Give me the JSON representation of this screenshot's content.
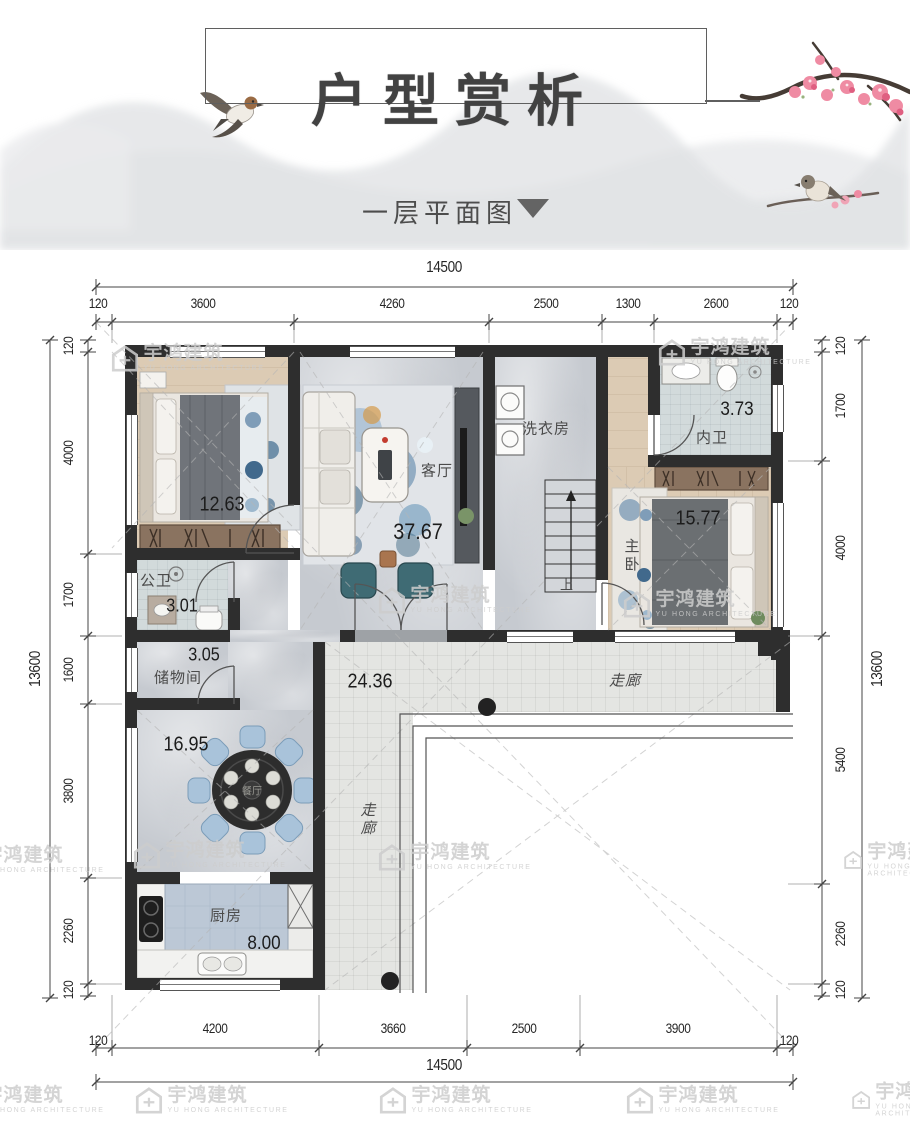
{
  "header": {
    "title": "户型赏析",
    "subtitle": "一层平面图"
  },
  "watermark": {
    "cn": "宇鸿建筑",
    "en": "YU HONG ARCHITECTURE"
  },
  "dims": {
    "top_total": "14500",
    "top": [
      "120",
      "3600",
      "4260",
      "2500",
      "1300",
      "2600",
      "120"
    ],
    "bottom": [
      "120",
      "4200",
      "3660",
      "2500",
      "3900",
      "120"
    ],
    "bottom_total": "14500",
    "left": [
      "120",
      "4000",
      "1700",
      "1600",
      "3800",
      "2260",
      "120"
    ],
    "left_total": "13600",
    "right": [
      "120",
      "1700",
      "4000",
      "5400",
      "2260",
      "120"
    ],
    "right_total": "13600"
  },
  "rooms": {
    "bedroom1": {
      "area": "12.63"
    },
    "living": {
      "name": "客厅",
      "area": "37.67"
    },
    "laundry": {
      "name": "洗衣房"
    },
    "inner_bath": {
      "name": "内卫",
      "area": "3.73"
    },
    "master": {
      "name": "主卧",
      "area": "15.77"
    },
    "public_bath": {
      "name": "公卫",
      "area": "3.01"
    },
    "storage": {
      "name": "储物间",
      "area": "3.05"
    },
    "porch": {
      "area": "24.36"
    },
    "corridor_top": {
      "name": "走廊"
    },
    "corridor_side": {
      "name": "走廊"
    },
    "dining": {
      "area": "16.95",
      "table_label": "餐厅"
    },
    "kitchen": {
      "name": "厨房",
      "area": "8.00"
    },
    "stairs": {
      "up": "上"
    }
  },
  "colors": {
    "wall": "#2e2e2e",
    "wood": "#dccbb4",
    "marble": "#c6cad0",
    "tile": "#e4e5e2",
    "accent_blue": "#5d87aa",
    "chair_blue": "#a9c3da",
    "blossom_pink": "#ef8ba3",
    "teal_chair": "#3f6b74"
  }
}
